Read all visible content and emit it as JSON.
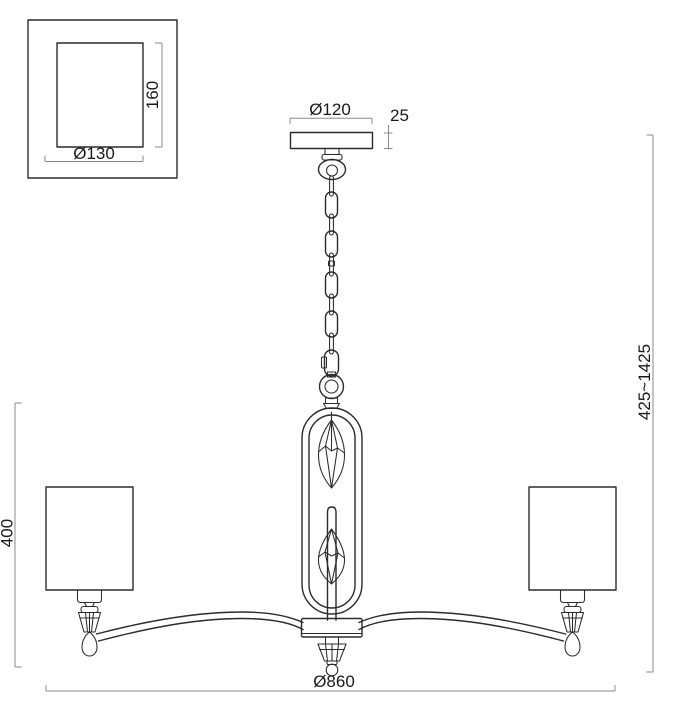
{
  "drawing": {
    "title": "chandelier-technical-drawing",
    "labels": {
      "canopy_plan_width": "Ø130",
      "canopy_plan_height": "160",
      "canopy_diameter": "Ø120",
      "canopy_thickness": "25",
      "hanging_height": "425~1425",
      "body_height": "400",
      "overall_width": "Ø860"
    },
    "colors": {
      "line": "#2b2b2b",
      "dimension": "#8a8a8a",
      "text": "#1a1a1a",
      "background": "#ffffff"
    }
  }
}
